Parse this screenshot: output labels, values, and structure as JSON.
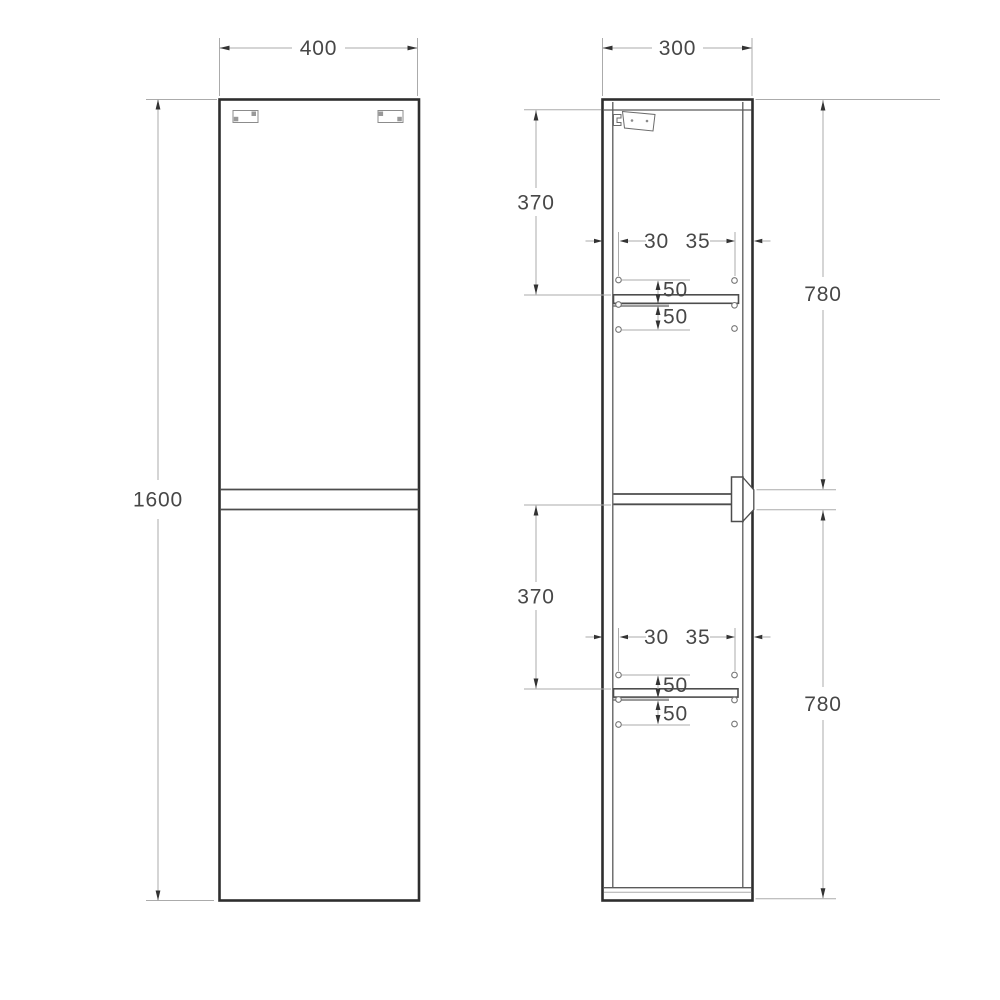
{
  "front_view": {
    "width": "400",
    "height": "1600"
  },
  "side_view": {
    "depth": "300",
    "upper": {
      "top_offset": "370",
      "section_height": "780",
      "hole_back_offset": "30",
      "hole_front_offset": "35",
      "hole_pitch_above": "50",
      "hole_pitch_below": "50"
    },
    "lower": {
      "top_offset": "370",
      "section_height": "780",
      "hole_back_offset": "30",
      "hole_front_offset": "35",
      "hole_pitch_above": "50",
      "hole_pitch_below": "50"
    }
  },
  "colors": {
    "object_line": "#2e2e2e",
    "secondary_line": "#5a5a5a",
    "dimension_line": "#ababab",
    "arrowhead": "#333333",
    "label_text": "#474747",
    "background": "#ffffff"
  }
}
